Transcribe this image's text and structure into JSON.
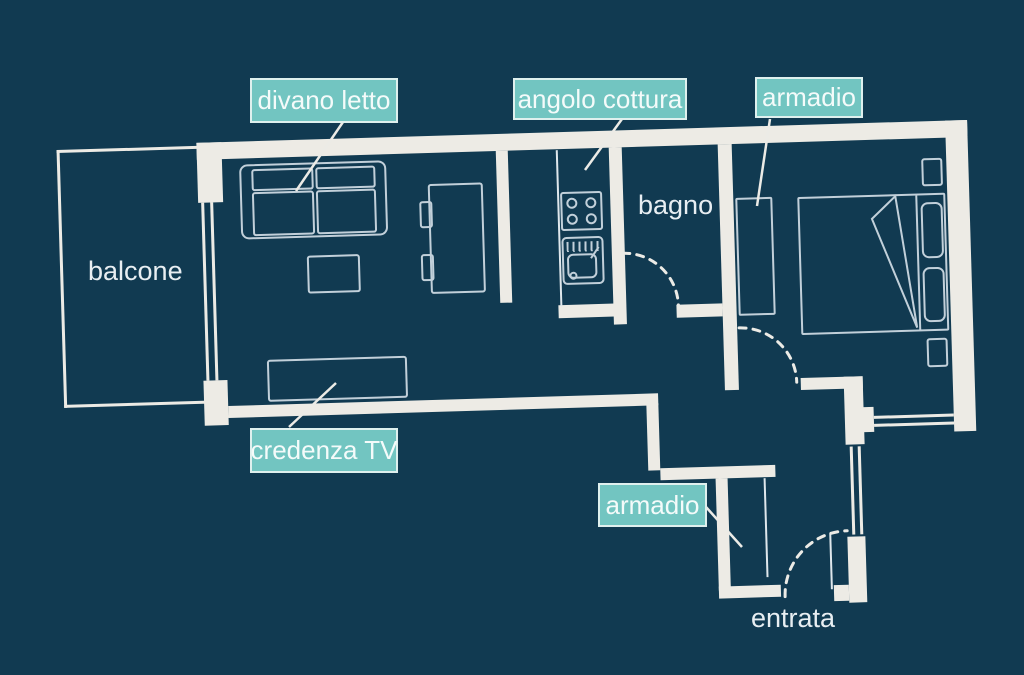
{
  "colors": {
    "background": "#113a51",
    "wall": "#edebe5",
    "furniture_line": "#c2d0da",
    "label_fill": "#72c5c1",
    "label_border": "#dff0ee",
    "label_text": "#f4fbfa",
    "room_text": "#e8eef2"
  },
  "labels": {
    "divano_letto": "divano letto",
    "angolo_cottura": "angolo cottura",
    "armadio_bedroom": "armadio",
    "credenza_tv": "credenza TV",
    "armadio_hall": "armadio"
  },
  "rooms": {
    "balcone": "balcone",
    "bagno": "bagno",
    "entrata": "entrata"
  }
}
